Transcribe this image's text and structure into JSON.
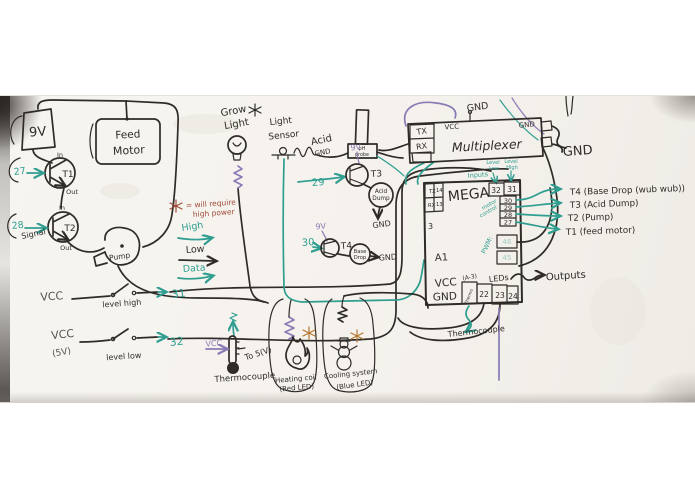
{
  "colors": {
    "ink": "#2e2b28",
    "teal": "#2f9e90",
    "purple": "#8a7ab5",
    "red": "#9e4b38",
    "orange": "#b5762f"
  },
  "icons": {
    "high_power_marker": "asterisk-star"
  },
  "legend": {
    "star_note_line1": "= will require",
    "star_note_line2": "high power",
    "high": "High",
    "low": "Low",
    "data": "Data"
  },
  "power": {
    "battery": "9V",
    "feed_motor_line1": "Feed",
    "feed_motor_line2": "Motor",
    "pump": "Pump",
    "t1": {
      "name": "T1",
      "pin": "27",
      "in": "In",
      "out": "Out"
    },
    "t2": {
      "name": "T2",
      "pin": "28",
      "in": "In",
      "out": "Out",
      "signal": "Signal"
    }
  },
  "grow_light": {
    "line1": "Grow",
    "line2": "Light"
  },
  "light_sensor": {
    "line1": "Light",
    "line2": "Sensor"
  },
  "ph": {
    "acid": "Acid",
    "gnd": "GND",
    "probe_line1": "pH",
    "probe_line2": "probe"
  },
  "t3_circuit": {
    "pin": "29",
    "supply": "9V",
    "name": "T3",
    "load_line1": "Acid",
    "load_line2": "Dump",
    "gnd": "GND"
  },
  "t4_circuit": {
    "pin": "30",
    "supply": "9V",
    "name": "T4",
    "load_line1": "Base",
    "load_line2": "Drop",
    "gnd": "GND"
  },
  "multiplexer": {
    "title": "Multiplexer",
    "tx": "TX",
    "rx": "RX",
    "vcc": "VCC",
    "gnd": "GND",
    "top_gnd": "GND",
    "right_gnd": "GND"
  },
  "mega": {
    "title": "MEGA",
    "tx": "TX",
    "tx_pin": "14",
    "rx": "RX",
    "rx_pin": "13",
    "inputs": "Inputs",
    "level_low_line1": "Level",
    "level_low_line2": "Low",
    "level_high_line1": "Level",
    "level_high_line2": "High",
    "pin_32": "32",
    "pin_31": "31",
    "motor_control_line1": "motor",
    "motor_control_line2": "control",
    "right_pins": [
      "30",
      "29",
      "28",
      "27"
    ],
    "pin_3": "3",
    "pwm_label": "PWM:",
    "pwm_pins": [
      "46",
      "45"
    ],
    "a1": "A1",
    "vcc": "VCC",
    "gnd": "GND",
    "a3_label": "(A-3)",
    "thermo_pin": "Thermo",
    "leds_label": "LEDs",
    "bottom_pins": [
      "22",
      "23",
      "24"
    ],
    "thermocouple_note": "Thermocouple"
  },
  "outputs_label": "Outputs",
  "transistor_key": [
    "T4 (Base Drop (wub wub))",
    "T3 (Acid Dump)",
    "T2 (Pump)",
    "T1 (feed motor)"
  ],
  "level_switches": {
    "high": {
      "vcc": "VCC",
      "label": "level high",
      "pin": "31"
    },
    "low": {
      "vcc": "VCC",
      "vcc_sub": "(5V)",
      "label": "level low",
      "pin": "32"
    }
  },
  "thermocouple": {
    "vcc": "VCC",
    "right_label": "To 5(V)",
    "caption": "Thermocouple"
  },
  "heating": {
    "caption_line1": "Heating coil",
    "caption_line2": "(Red LED)"
  },
  "cooling": {
    "caption_line1": "Cooling system",
    "caption_line2": "(Blue LED)"
  }
}
